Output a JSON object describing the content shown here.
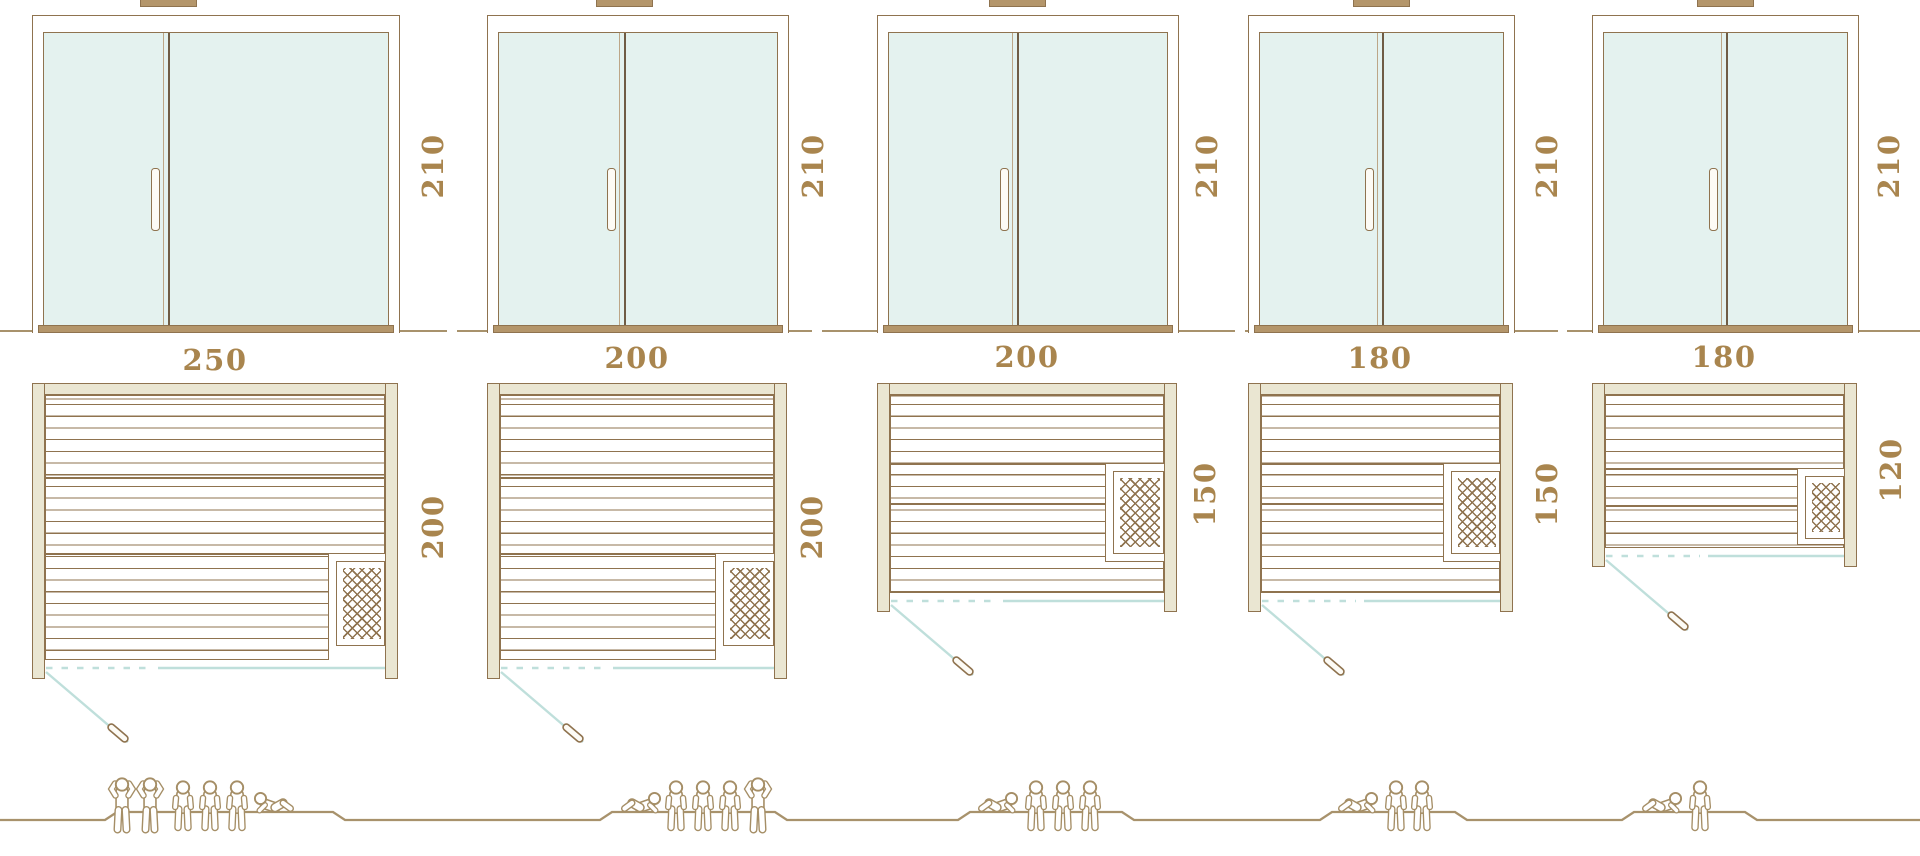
{
  "diagram": {
    "description": "Sauna size comparison: front elevations with glass double doors, floor plans with heater, and capacity figures",
    "door_height_unit": "210"
  },
  "saunas": [
    {
      "name": "sauna-250x200",
      "front_width": "250",
      "height": "210",
      "depth": "200",
      "capacity": 6,
      "people": [
        "standing",
        "standing",
        "sitting",
        "sitting",
        "sitting",
        "lying"
      ]
    },
    {
      "name": "sauna-200x200",
      "front_width": "200",
      "height": "210",
      "depth": "200",
      "capacity": 5,
      "people": [
        "lying",
        "sitting",
        "sitting",
        "sitting",
        "standing"
      ]
    },
    {
      "name": "sauna-200x150",
      "front_width": "200",
      "height": "210",
      "depth": "150",
      "capacity": 4,
      "people": [
        "lying",
        "sitting",
        "sitting",
        "sitting"
      ]
    },
    {
      "name": "sauna-180x150",
      "front_width": "180",
      "height": "210",
      "depth": "150",
      "capacity": 3,
      "people": [
        "lying",
        "sitting",
        "sitting"
      ]
    },
    {
      "name": "sauna-180x120",
      "front_width": "180",
      "height": "210",
      "depth": "120",
      "capacity": 2,
      "people": [
        "lying",
        "sitting"
      ]
    }
  ],
  "colors": {
    "outline_brown": "#8f734f",
    "divider_dark": "#6f5c45",
    "frame_beige": "#eae6d2",
    "glass_teal": "#e4f2ef",
    "door_swing_teal": "#bfdfdb",
    "sill_tan": "#b4966b",
    "label_text": "#a9854e",
    "figure_outline": "#a58e66"
  }
}
